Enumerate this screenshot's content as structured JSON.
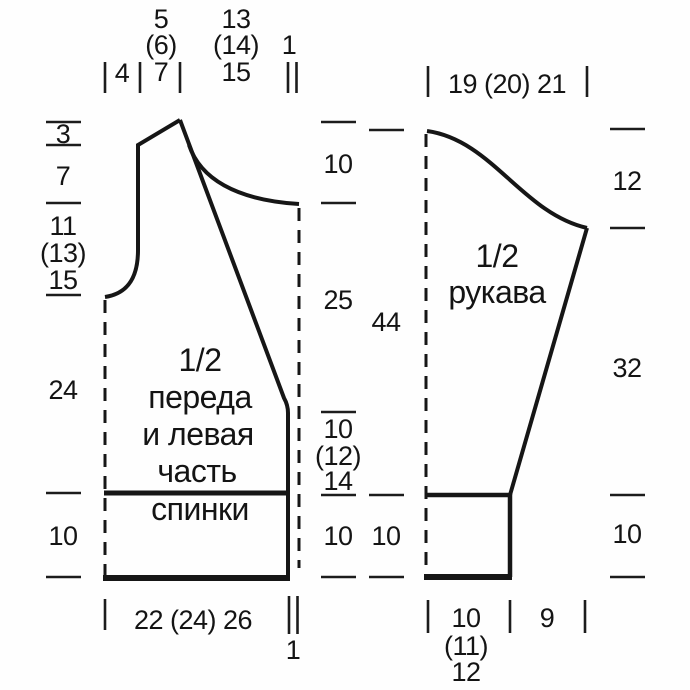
{
  "diagram": {
    "front": {
      "name_lines": [
        "1/2",
        "переда",
        "и левая",
        "часть",
        "спинки"
      ],
      "top": {
        "armhole_width": "4",
        "shoulder_width": [
          "5",
          "(6)",
          "7"
        ],
        "neck_width": [
          "13",
          "(14)",
          "15"
        ],
        "band_width": "1"
      },
      "left": {
        "shoulder_slope": "3",
        "upper_armhole": "7",
        "armhole_depth": [
          "11",
          "(13)",
          "15"
        ],
        "side_length": "24",
        "ribbing_height": "10"
      },
      "inner": {
        "neck_depth": "10",
        "raglan_length": "25",
        "lower_section": [
          "10",
          "(12)",
          "14"
        ],
        "ribbing_height": "10"
      },
      "bottom": {
        "hem_width": "22 (24) 26",
        "band_width": "1"
      }
    },
    "sleeve": {
      "name_lines": [
        "1/2",
        "рукава"
      ],
      "top": {
        "width": "19 (20) 21"
      },
      "inner": {
        "length": "44",
        "ribbing_height": "10"
      },
      "right": {
        "cap_height": "12",
        "seam_length": "32",
        "cuff_height": "10"
      },
      "bottom": {
        "cuff_width": [
          "10",
          "(11)",
          "12"
        ],
        "underarm_offset": "9"
      }
    }
  }
}
